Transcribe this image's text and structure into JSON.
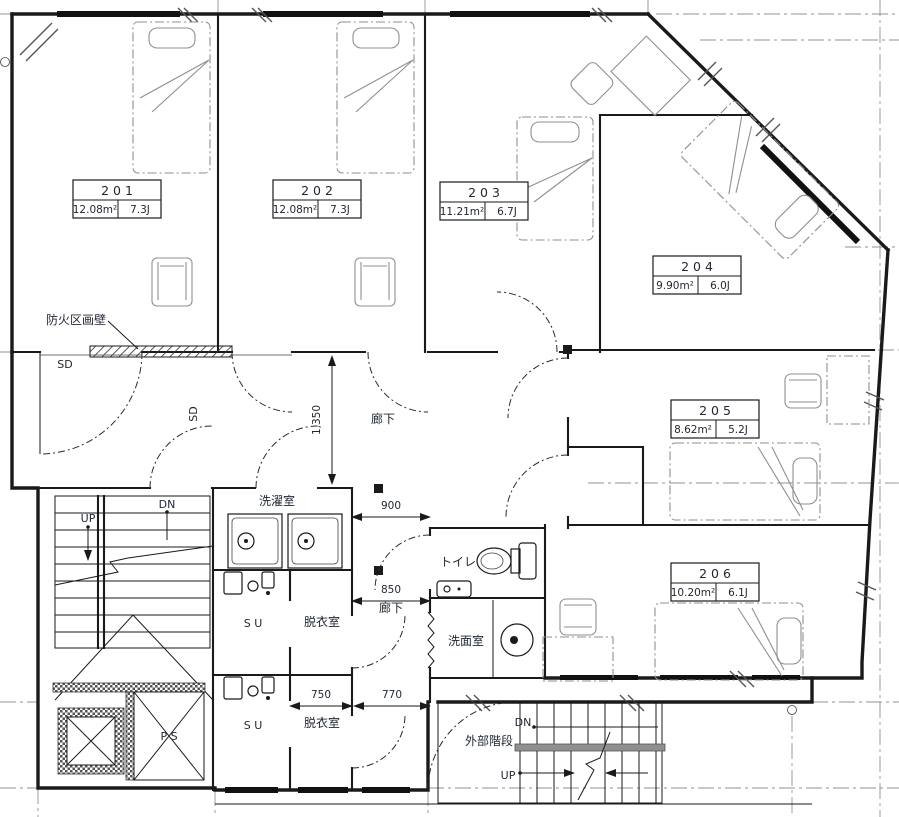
{
  "rooms": [
    {
      "number": "2 0 1",
      "area": "12.08m²",
      "size": "7.3J"
    },
    {
      "number": "2 0 2",
      "area": "12.08m²",
      "size": "7.3J"
    },
    {
      "number": "2 0 3",
      "area": "11.21m²",
      "size": "6.7J"
    },
    {
      "number": "2 0 4",
      "area": "9.90m²",
      "size": "6.0J"
    },
    {
      "number": "2 0 5",
      "area": "8.62m²",
      "size": "5.2J"
    },
    {
      "number": "2 0 6",
      "area": "10.20m²",
      "size": "6.1J"
    }
  ],
  "labels": {
    "fire_wall": "防火区画壁",
    "steel_door": "SD",
    "corridor": "廊下",
    "laundry_room": "洗濯室",
    "toilet": "トイレ",
    "washroom": "洗面室",
    "dressing_room": "脱衣室",
    "shower_unit": "S U",
    "pipe_shaft": "P S",
    "up": "UP",
    "down": "DN",
    "external_stairs": "外部階段"
  },
  "dimensions": {
    "corridor_main": "1,350",
    "corridor_upper": "900",
    "corridor_lower": "850",
    "dressing_width": "750",
    "corridor_width": "770"
  },
  "colors": {
    "wall": "#1a1a1a",
    "furniture": "#8f8f8f",
    "background": "#ffffff"
  }
}
